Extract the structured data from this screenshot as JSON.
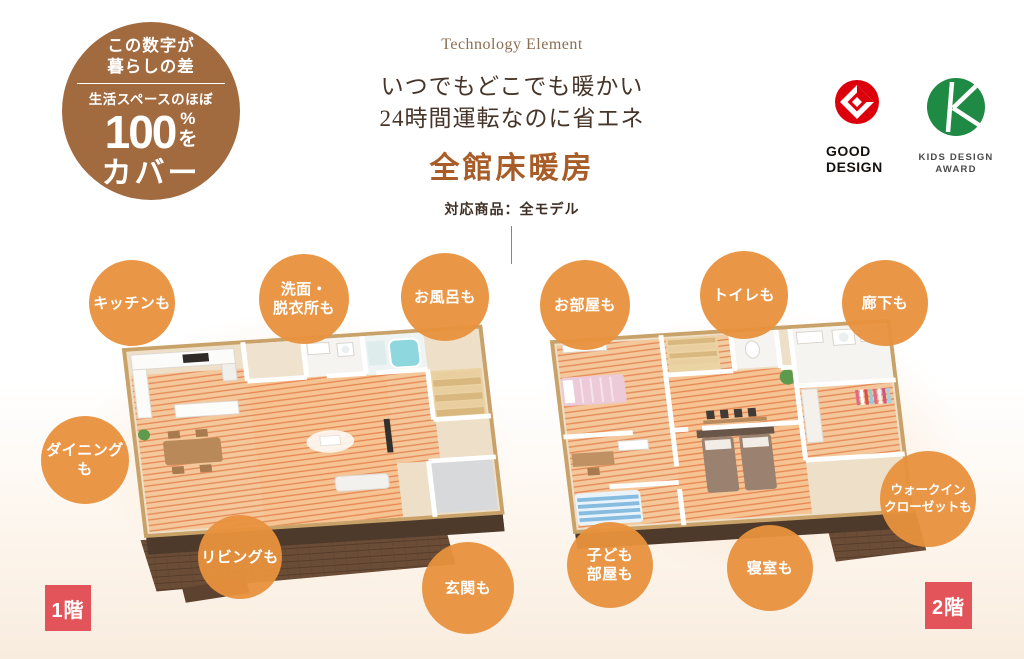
{
  "badge": {
    "line1": "この数字が",
    "line2": "暮らしの差",
    "sub": "生活スペースのほぼ",
    "number": "100",
    "percent": "%",
    "particle": "を",
    "cover": "カバー"
  },
  "header": {
    "eyebrow": "Technology Element",
    "catch1": "いつでもどこでも暖かい",
    "catch2": "24時間運転なのに省エネ",
    "title": "全館床暖房",
    "subtitle": "対応商品：全モデル"
  },
  "awards": {
    "good_design": {
      "name1": "GOOD",
      "name2": "DESIGN"
    },
    "kids_design": {
      "name1": "KIDS DESIGN",
      "name2": "AWARD"
    }
  },
  "floor1": {
    "label": "1階",
    "bubbles": [
      "キッチンも",
      "洗面・\n脱衣所も",
      "お風呂も",
      "ダイニングも",
      "リビングも",
      "玄関も"
    ]
  },
  "floor2": {
    "label": "2階",
    "bubbles": [
      "お部屋も",
      "トイレも",
      "廊下も",
      "ウォークイン\nクローゼットも",
      "子ども\n部屋も",
      "寝室も"
    ]
  },
  "colors": {
    "bubble_orange": "#E8913D",
    "badge_brown": "#A26A3F",
    "title_orange": "#A85D28",
    "floor_label_red": "#E25459",
    "good_design_red": "#DC000C",
    "kids_design_green": "#1F8A44"
  }
}
